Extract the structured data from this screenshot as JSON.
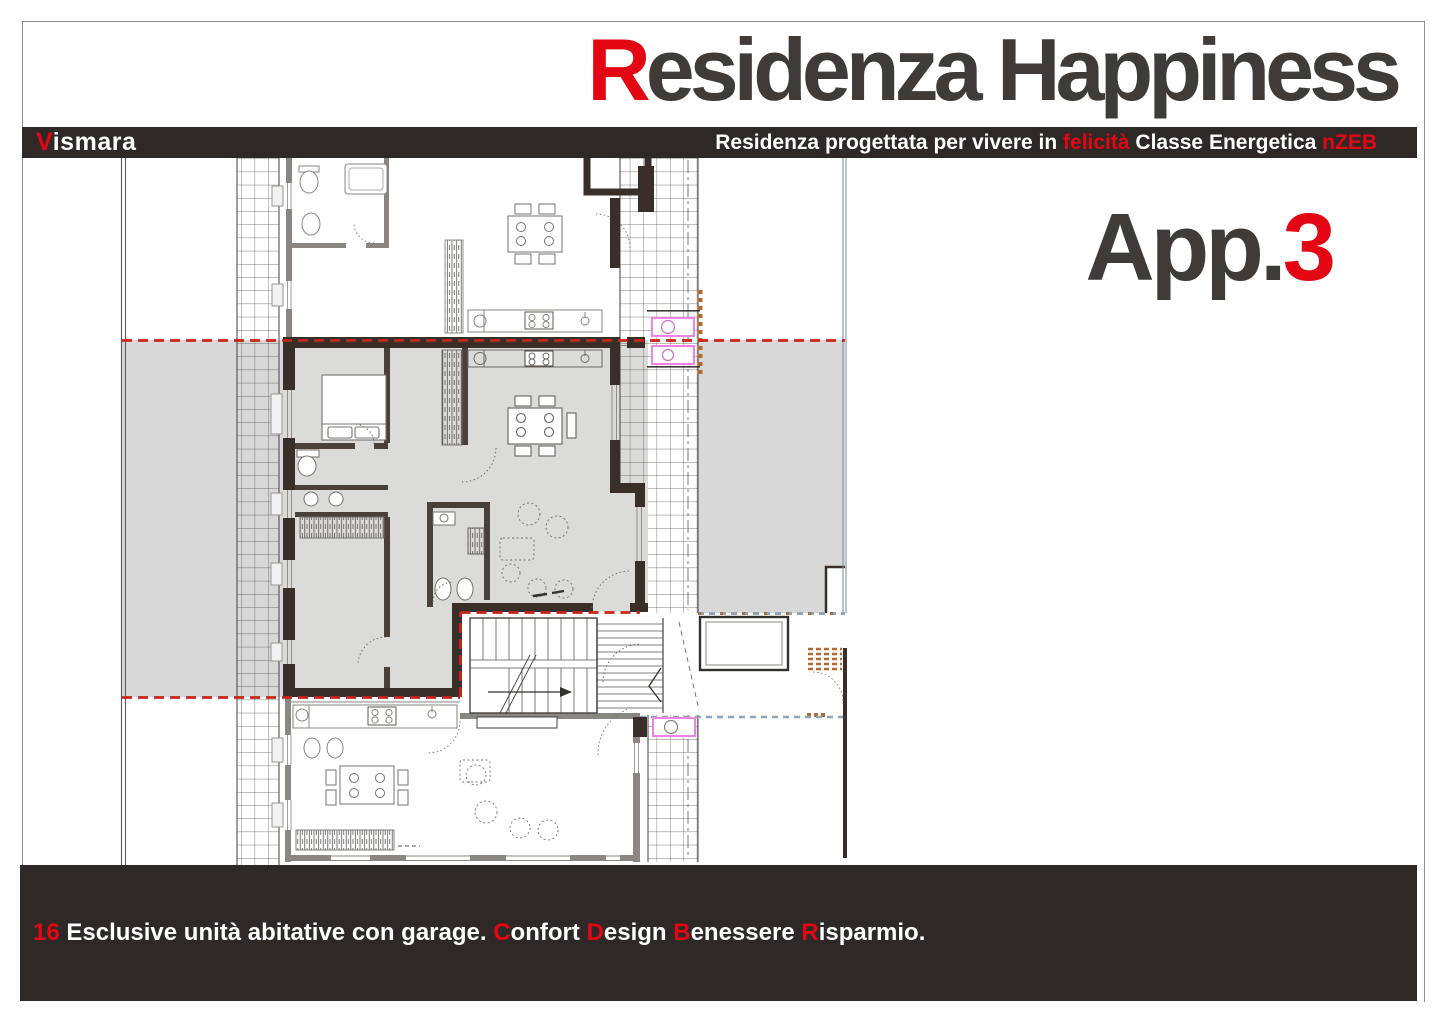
{
  "header": {
    "title_accent": "R",
    "title_rest": "esidenza Happiness"
  },
  "brand_bar": {
    "brand_accent": "V",
    "brand_rest": "ismara",
    "tagline_pre": "Residenza progettata per vivere in ",
    "tagline_accent_1": "felicità",
    "tagline_mid": " Classe Energetica ",
    "tagline_accent_2": "nZEB"
  },
  "apartment": {
    "label_prefix": "App.",
    "label_number": "3"
  },
  "footer": {
    "accent_number": "16",
    "segment_1": " Esclusive unità abitative con garage. ",
    "accent_confort": "C",
    "segment_2": "onfort ",
    "accent_design": "D",
    "segment_3": "esign ",
    "accent_benessere": "B",
    "segment_4": "enessere ",
    "accent_risparmio": "R",
    "segment_5": "isparmio."
  },
  "colors": {
    "accent_red": "#e30613",
    "bar_background": "#2e2927",
    "title_gray": "#3e3b39",
    "terrace_gray": "#d8d8d8",
    "apartment_floor_gray": "#dbdbda",
    "wall_dark": "#3a2f28",
    "boundary_dashed_red": "#c9251a",
    "fixture_magenta": "#ee82e8",
    "railing_blue_gray": "#8fa3b5",
    "hatch_brown": "#b06a32"
  }
}
